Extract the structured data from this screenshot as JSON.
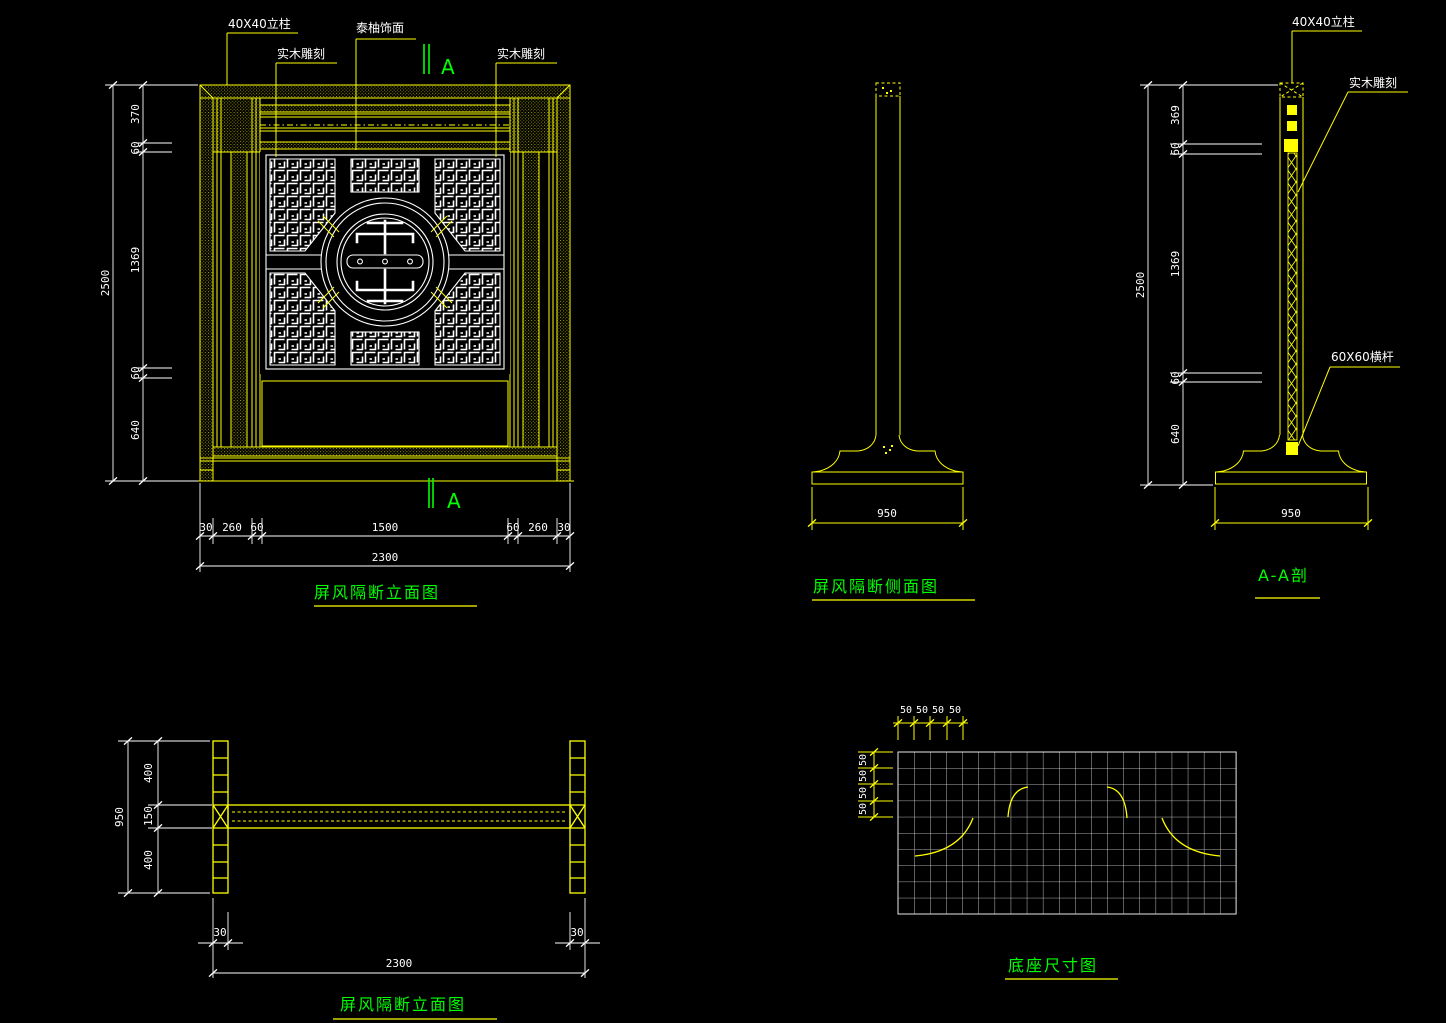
{
  "colors": {
    "background": "#000000",
    "geometry": "#ffff00",
    "dimension": "#ffffff",
    "title": "#00ff00",
    "hatch_dot": "#a8a800"
  },
  "front": {
    "title": "屏风隔断立面图",
    "label_post": "40X40立柱",
    "label_carving_left": "实木雕刻",
    "label_veneer": "泰柚饰面",
    "label_carving_right": "实木雕刻",
    "section_mark_top": "A",
    "section_mark_bottom": "A",
    "dim_overall_height": "2500",
    "height_segments": [
      "370",
      "60",
      "1369",
      "60",
      "640"
    ],
    "dim_overall_width": "2300",
    "width_segments": [
      "30",
      "260",
      "60",
      "1500",
      "60",
      "260",
      "30"
    ]
  },
  "side": {
    "title": "屏风隔断侧面图",
    "dim_width": "950"
  },
  "section": {
    "title": "A-A剖",
    "label_post": "40X40立柱",
    "label_carving": "实木雕刻",
    "label_rail": "60X60横杆",
    "dim_overall_height": "2500",
    "height_segments": [
      "369",
      "60",
      "1369",
      "60",
      "640"
    ],
    "dim_width": "950"
  },
  "plan": {
    "title": "屏风隔断立面图",
    "dim_overall_depth": "950",
    "depth_segments": [
      "400",
      "150",
      "400"
    ],
    "dim_post_left": "30",
    "dim_post_right": "30",
    "dim_overall_width": "2300"
  },
  "base": {
    "title": "底座尺寸图",
    "dims_top": [
      "50",
      "50",
      "50",
      "50"
    ],
    "dims_left": [
      "50",
      "50",
      "50",
      "50"
    ]
  }
}
